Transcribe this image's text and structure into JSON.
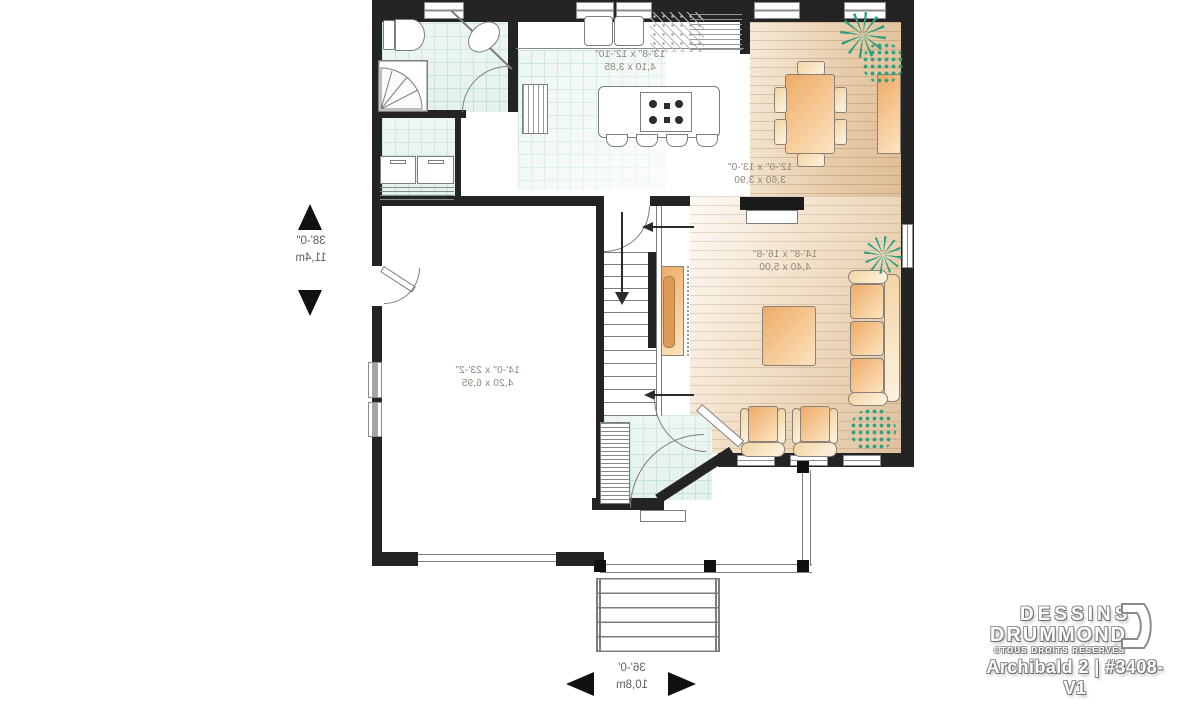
{
  "floor_plan": {
    "rooms": {
      "kitchen": {
        "size_imperial": "13'-8\" x 12'-10\"",
        "size_metric": "4,10 x 3,85"
      },
      "dining_room": {
        "size_imperial": "12'-0\" x 13'-0\"",
        "size_metric": "3,60 x 3,90"
      },
      "living_room": {
        "size_imperial": "14'-8\" x 16'-8\"",
        "size_metric": "4,40 x 5,00"
      },
      "garage": {
        "size_imperial": "14'-0\" x 23'-2\"",
        "size_metric": "4,20 x 6,95"
      }
    },
    "dimensions": {
      "depth": {
        "imperial": "38'-0\"",
        "metric": "11,4m"
      },
      "width": {
        "imperial": "36'-0'",
        "metric": "10,8m"
      }
    }
  },
  "branding": {
    "studio_line1": "DESSINS",
    "studio_line2": "DRUMMOND",
    "rights": "©TOUS DROITS RÉSERVÉS",
    "plan_title": "Archibald 2 | #3408-V1"
  },
  "colors": {
    "wall": "#242424",
    "tile_floor": "#e0efe9",
    "wood_floor": "#e7cba8",
    "furniture_accent": "#eeab67",
    "plant": "#2f9f81",
    "label_text": "#8f8678"
  }
}
